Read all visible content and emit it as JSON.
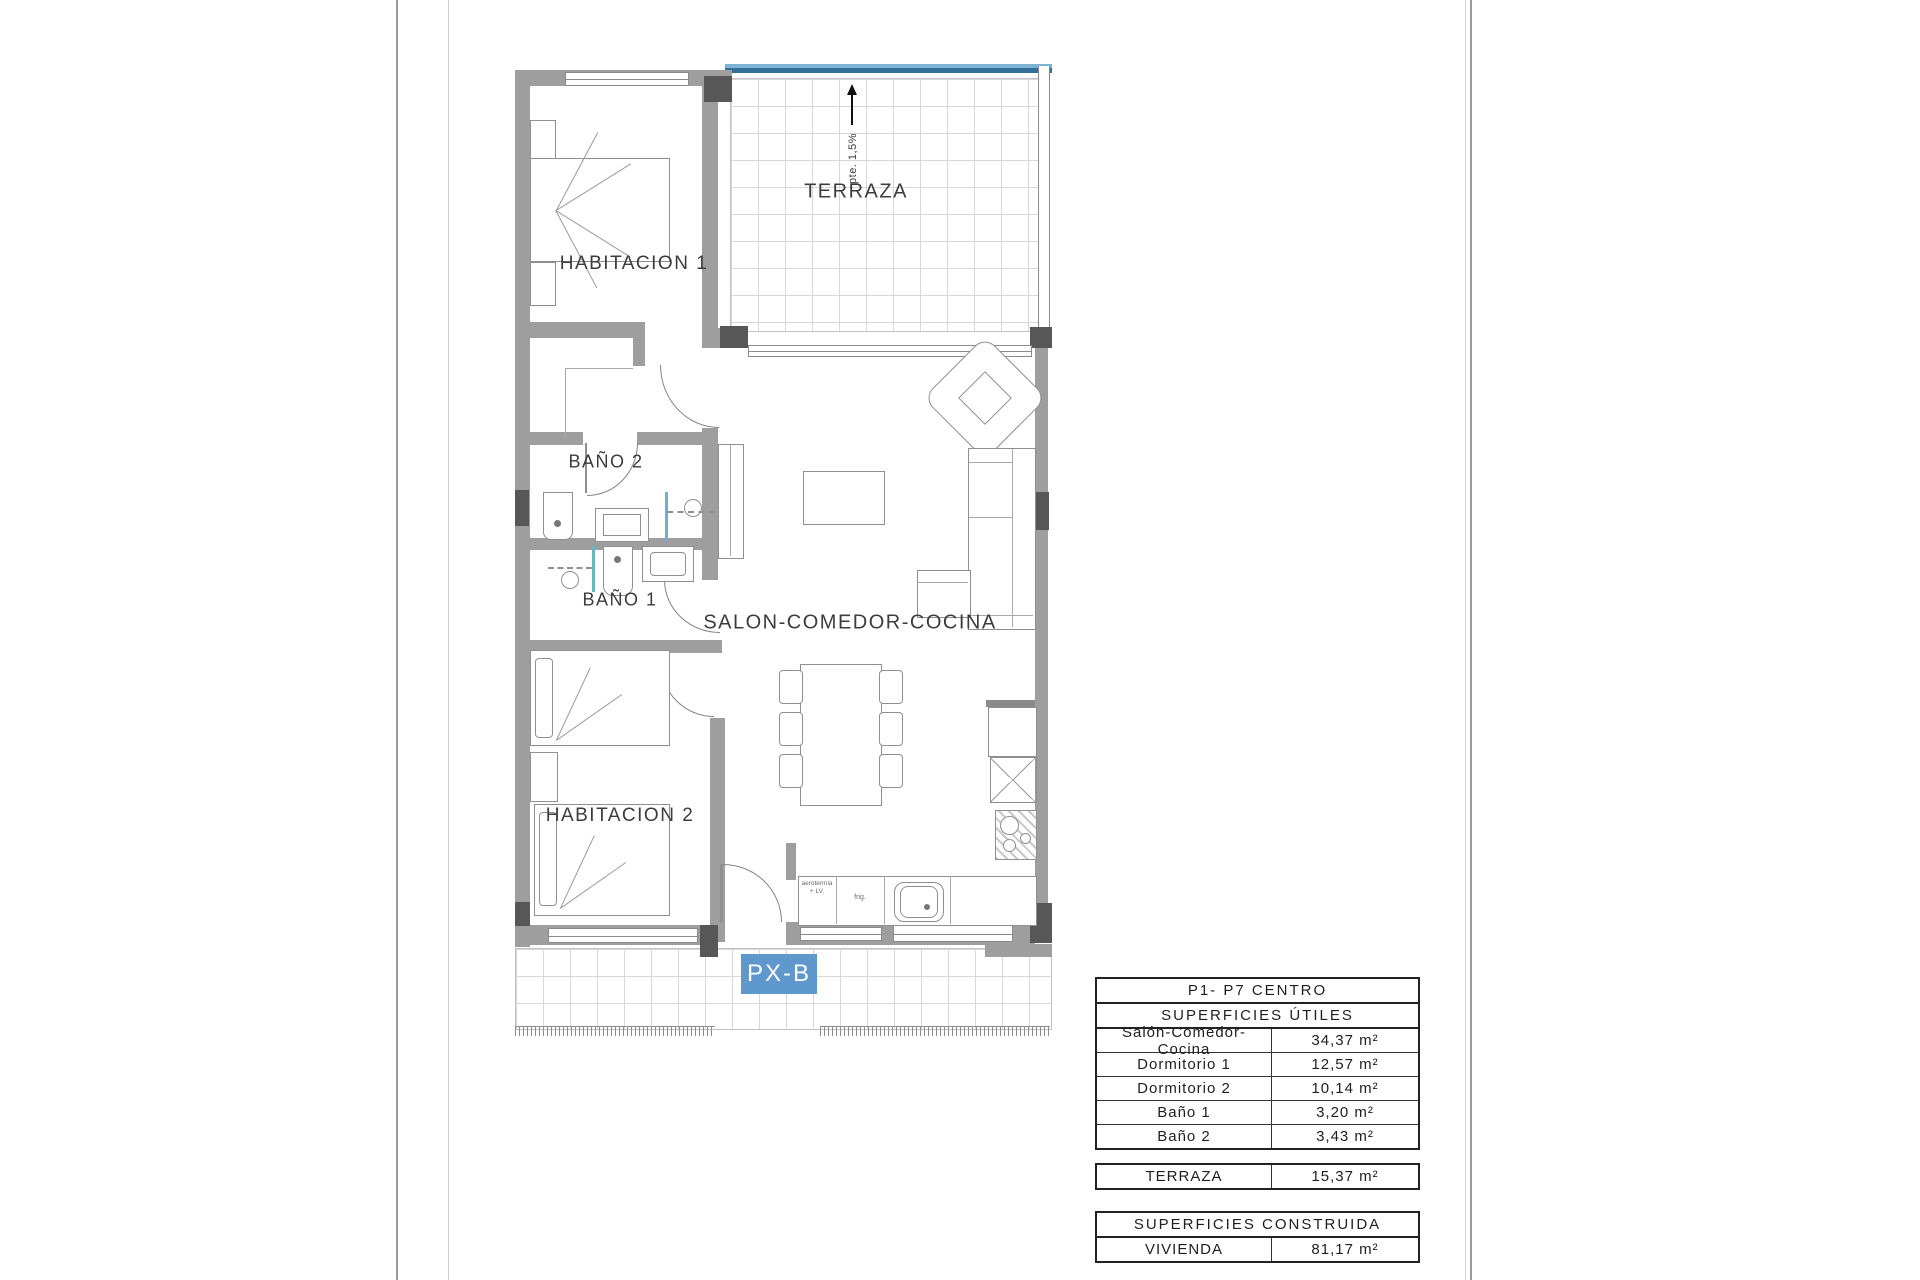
{
  "plan": {
    "labels": {
      "habitacion1": "HABITACION 1",
      "habitacion2": "HABITACION 2",
      "bano1": "BAÑO 1",
      "bano2": "BAÑO 2",
      "salon": "SALON-COMEDOR-COCINA",
      "terraza": "TERRAZA",
      "slope": "pte. 1,5%",
      "unit_tag": "PX-B",
      "kitchen_appliance_note": "aerotermia + LV.",
      "fridge_note": "frig."
    },
    "colors": {
      "wall": "#9e9e9e",
      "column": "#575757",
      "terrace_rail_light": "#7fb3d3",
      "terrace_rail_dark": "#336f96",
      "unit_tag_bg": "#5f98cd",
      "shower_glass": "#6db3c4"
    }
  },
  "tables": {
    "utiles": {
      "title": "P1- P7 CENTRO",
      "subtitle": "SUPERFICIES ÚTILES",
      "rows": [
        {
          "label": "Salón-Comedor-Cocina",
          "value": "34,37 m²"
        },
        {
          "label": "Dormitorio 1",
          "value": "12,57 m²"
        },
        {
          "label": "Dormitorio 2",
          "value": "10,14 m²"
        },
        {
          "label": "Baño 1",
          "value": "3,20 m²"
        },
        {
          "label": "Baño 2",
          "value": "3,43 m²"
        }
      ]
    },
    "terraza": {
      "label": "TERRAZA",
      "value": "15,37 m²"
    },
    "construida": {
      "title": "SUPERFICIES CONSTRUIDA",
      "rows": [
        {
          "label": "VIVIENDA",
          "value": "81,17 m²"
        }
      ]
    }
  }
}
